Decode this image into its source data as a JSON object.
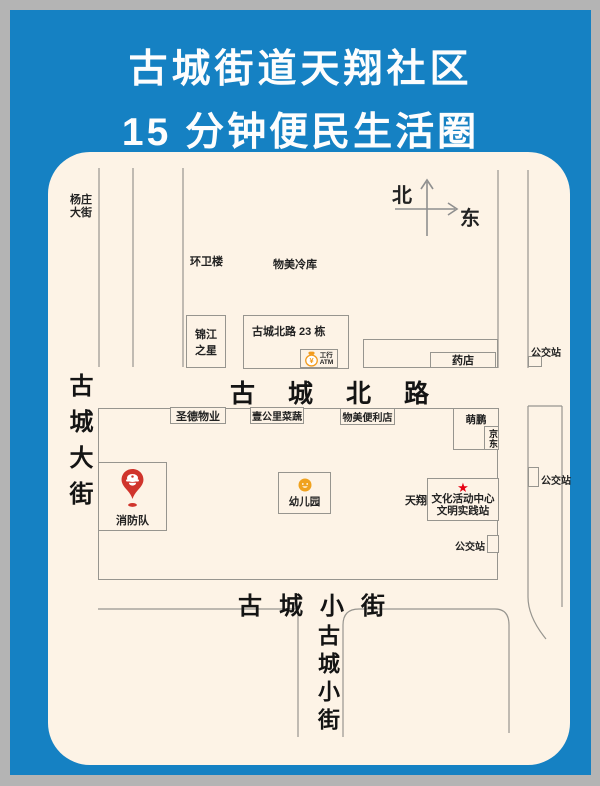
{
  "header": {
    "title_line1": "古城街道天翔社区",
    "title_line2": "15 分钟便民生活圈"
  },
  "compass": {
    "north": "北",
    "east": "东"
  },
  "streets": {
    "yangzhuang_l1": "杨庄",
    "yangzhuang_l2": "大街",
    "gucheng_dajie": "古城大街",
    "gucheng_beilu": "古城北路",
    "gucheng_xiaojie_horizontal": "古城小街",
    "gucheng_xiaojie_vertical": "古城小街"
  },
  "places": {
    "huanweilou": "环卫楼",
    "wumei_lengku": "物美冷库",
    "jinjiang_l1": "锦江",
    "jinjiang_l2": "之星",
    "beilu_23": "古城北路 23 栋",
    "atm_l1": "工行",
    "atm_l2": "ATM",
    "yaodian": "药店",
    "bus_stop": "公交站",
    "shengde_wuye": "圣德物业",
    "yigongli_caishu": "壹公里菜蔬",
    "wumei_bianlidian": "物美便利店",
    "mengpeng": "萌鹏",
    "jingdong": "京东",
    "xiaofangdui": "消防队",
    "youeryuan": "幼儿园",
    "tianxiang": "天翔",
    "wenhua_l1": "文化活动中心",
    "wenhua_l2": "文明实践站"
  },
  "icons": {
    "star": "★",
    "yuan_sign": "¥"
  },
  "colors": {
    "board_blue": "#1581c3",
    "map_cream": "#fdf3e6",
    "street_line_gray": "#97958f",
    "fire_pin_red": "#d0342c",
    "star_red": "#e60012",
    "icbc_orange": "#f29b1d",
    "frame_gray": "#b4b4b4"
  }
}
